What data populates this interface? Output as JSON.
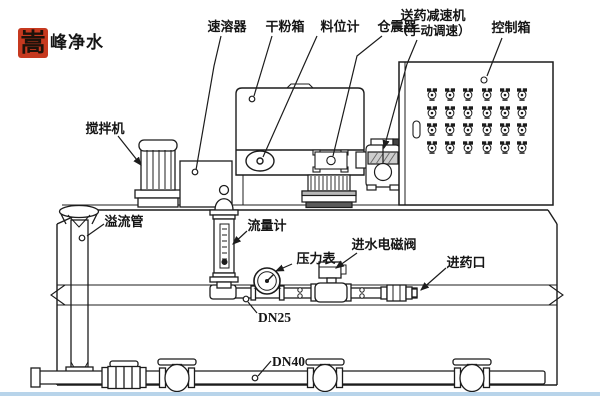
{
  "brand": {
    "stamp_character": "嵩",
    "brand_name": "峰净水"
  },
  "equipment_labels": {
    "dissolver": "速溶器",
    "dry_powder_box": "干粉箱",
    "material_level_gauge": "料位计",
    "bin_vibrator": "仓震器",
    "dosing_reducer_line1": "送药减速机",
    "dosing_reducer_line2": "（手动调速）",
    "control_box": "控制箱",
    "mixer": "搅拌机",
    "overflow_pipe": "溢流管",
    "flow_meter": "流量计",
    "pressure_gauge": "压力表",
    "inlet_solenoid_valve": "进水电磁阀",
    "dosing_inlet": "进药口"
  },
  "pipe_labels": {
    "dosing_pipe_size": "DN25",
    "drain_pipe_size": "DN40"
  },
  "colors": {
    "line": "#1c1c1c",
    "stamp_red": "#c6391f",
    "bottom_strip_blue": "#b8d4ea"
  }
}
